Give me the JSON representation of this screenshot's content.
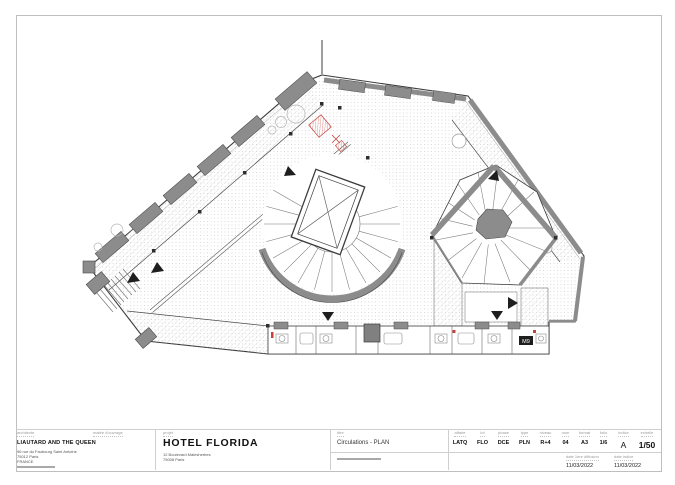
{
  "title_block": {
    "section_labels": {
      "architect": "architecte",
      "client": "maitre d'ouvrage",
      "project": "projet",
      "drawing": "titre"
    },
    "architect": {
      "name": "LIAUTARD AND THE QUEEN",
      "address": [
        "96 rue du Faubourg Saint Antoine",
        "75012 Paris",
        "FRANCE"
      ]
    },
    "project": {
      "name": "HOTEL FLORIDA",
      "address": [
        "12 Boulevard Malesherbes",
        "75008 Paris"
      ]
    },
    "drawing": {
      "title": "Circulations - PLAN"
    },
    "codes": [
      {
        "label": "affaire",
        "value": "LATQ"
      },
      {
        "label": "lot",
        "value": "FLO"
      },
      {
        "label": "phase",
        "value": "DCE"
      },
      {
        "label": "type",
        "value": "PLN"
      },
      {
        "label": "niveau",
        "value": "R+4"
      },
      {
        "label": "num",
        "value": "04"
      },
      {
        "label": "format",
        "value": "A3"
      },
      {
        "label": "folio",
        "value": "1/6"
      },
      {
        "label": "indice",
        "value": "A"
      },
      {
        "label": "echelle",
        "value": "1/50"
      }
    ],
    "dates": [
      {
        "label": "date 1ere diffusion",
        "value": "11/03/2022"
      },
      {
        "label": "date indice",
        "value": "11/03/2022"
      }
    ]
  },
  "plan": {
    "room_tag": "M9",
    "colors": {
      "wall": "#8c8c8c",
      "line": "#3c3c3c",
      "red": "#c8413a"
    }
  }
}
